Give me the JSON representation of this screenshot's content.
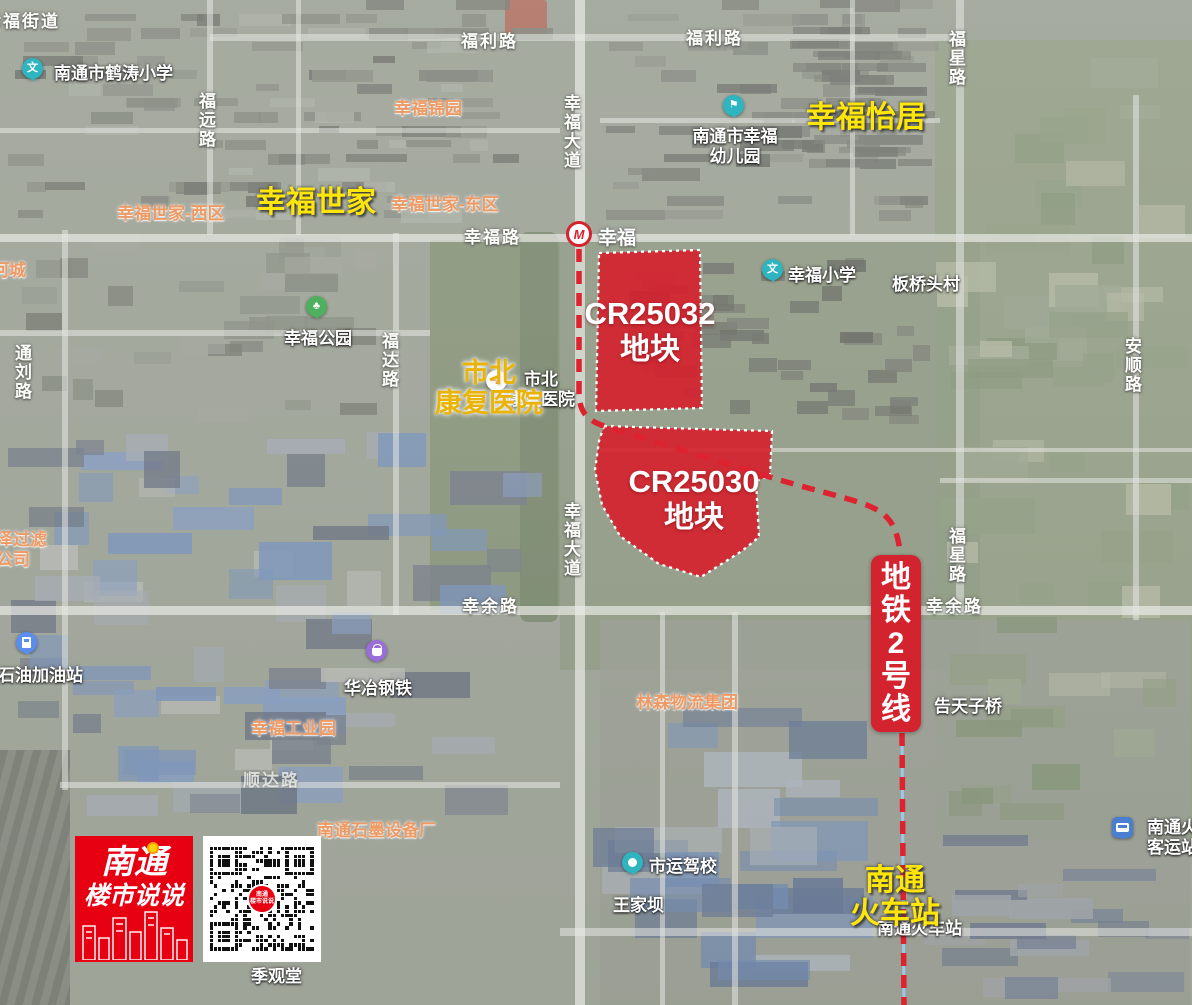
{
  "branding": {
    "logo_line1": "南通",
    "logo_line2": "楼市说说"
  },
  "parcels": [
    {
      "id": "CR25032",
      "label": "地块"
    },
    {
      "id": "CR25030",
      "label": "地块"
    }
  ],
  "metro": {
    "line_label": "地铁2号线",
    "station_name": "幸福"
  },
  "annotations": [
    {
      "name": "annotation-xingfu-shijia",
      "text": "幸福世家",
      "style": "yellow",
      "x": 256,
      "y": 186
    },
    {
      "name": "annotation-xingfu-yiju",
      "text": "幸福怡居",
      "style": "yellow",
      "x": 806,
      "y": 101
    },
    {
      "name": "annotation-shibei-hospital",
      "lines": [
        "市北",
        "康复医院"
      ],
      "style": "gold",
      "cx": 489,
      "y": 358
    },
    {
      "name": "annotation-train-station",
      "lines": [
        "南通",
        "火车站"
      ],
      "style": "yellow",
      "cx": 895,
      "y": 864
    }
  ],
  "map_labels": [
    {
      "name": "street-label-xingfu-jiedao",
      "text": "幸福街道",
      "type": "road",
      "x": -16,
      "y": 12
    },
    {
      "name": "poi-hetao-primary-school",
      "text": "南通市鹤涛小学",
      "type": "poi",
      "x": 54,
      "y": 64,
      "icon": {
        "type": "school",
        "x": 22,
        "y": 58
      }
    },
    {
      "name": "poi-xingfu-jinyuan",
      "text": "幸福锦园",
      "type": "orange",
      "x": 394,
      "y": 99
    },
    {
      "name": "poi-xingfu-shijia-west",
      "text": "幸福世家-西区",
      "type": "orange",
      "x": 117,
      "y": 204
    },
    {
      "name": "poi-xingfu-shijia-east",
      "text": "幸福世家-东区",
      "type": "orange",
      "x": 391,
      "y": 195
    },
    {
      "name": "road-fuli-left",
      "text": "福利路",
      "type": "road",
      "x": 461,
      "y": 32
    },
    {
      "name": "road-fuli-right",
      "text": "福利路",
      "type": "road",
      "x": 686,
      "y": 29
    },
    {
      "name": "road-fuyuan",
      "text": "福远路",
      "type": "road",
      "x": 199,
      "y": 92,
      "vertical": true
    },
    {
      "name": "road-xingfu-avenue-north",
      "text": "幸福大道",
      "type": "road",
      "x": 564,
      "y": 94,
      "vertical": true
    },
    {
      "name": "road-xingfu-avenue-south",
      "text": "幸福大道",
      "type": "road",
      "x": 564,
      "y": 502,
      "vertical": true
    },
    {
      "name": "road-fuxing-north",
      "text": "福星路",
      "type": "road",
      "x": 949,
      "y": 30,
      "vertical": true
    },
    {
      "name": "road-fuxing-south",
      "text": "福星路",
      "type": "road",
      "x": 949,
      "y": 527,
      "vertical": true
    },
    {
      "name": "poi-xingfu-kindergarten",
      "lines": [
        "南通市幸福",
        "幼儿园"
      ],
      "type": "poi",
      "x": 735,
      "y": 127,
      "centered": true,
      "icon": {
        "type": "kindergarten",
        "x": 723,
        "y": 95
      }
    },
    {
      "name": "road-xingfu-road",
      "text": "幸福路",
      "type": "road",
      "x": 464,
      "y": 228
    },
    {
      "name": "poi-hecheng",
      "text": "河城",
      "type": "orange",
      "x": -8,
      "y": 261
    },
    {
      "name": "poi-xingfu-primary-school",
      "text": "幸福小学",
      "type": "poi",
      "x": 788,
      "y": 266,
      "icon": {
        "type": "school",
        "x": 762,
        "y": 259
      }
    },
    {
      "name": "poi-banqiaotou-village",
      "text": "板桥头村",
      "type": "poi",
      "x": 892,
      "y": 275
    },
    {
      "name": "poi-xingfu-park",
      "text": "幸福公园",
      "type": "poi",
      "x": 284,
      "y": 329,
      "icon": {
        "type": "park",
        "x": 306,
        "y": 296
      }
    },
    {
      "name": "road-tongliu",
      "text": "通刘路",
      "type": "road",
      "x": 15,
      "y": 344,
      "vertical": true
    },
    {
      "name": "road-fuda",
      "text": "福达路",
      "type": "road",
      "x": 382,
      "y": 332,
      "vertical": true
    },
    {
      "name": "road-anshun",
      "text": "安顺路",
      "type": "road",
      "x": 1125,
      "y": 337,
      "vertical": true
    },
    {
      "name": "poi-shibei-hospital-map",
      "lines": [
        "市北",
        "康复医院"
      ],
      "type": "poi",
      "x": 541,
      "y": 370,
      "centered": true,
      "icon": {
        "type": "hospital",
        "x": 486,
        "y": 370
      }
    },
    {
      "name": "poi-zeguolv-company",
      "lines": [
        "泽过滤",
        "公司"
      ],
      "type": "orange",
      "x": -4,
      "y": 530
    },
    {
      "name": "road-xingyu-left",
      "text": "幸余路",
      "type": "road",
      "x": 462,
      "y": 597
    },
    {
      "name": "road-xingyu-right",
      "text": "幸余路",
      "type": "road",
      "x": 926,
      "y": 597
    },
    {
      "name": "poi-gas-station",
      "text": "石油加油站",
      "type": "poi",
      "x": -2,
      "y": 666,
      "icon": {
        "type": "gas",
        "x": 16,
        "y": 632
      }
    },
    {
      "name": "poi-huaye-steel",
      "text": "华冶钢铁",
      "type": "poi",
      "x": 344,
      "y": 679,
      "icon": {
        "type": "shop",
        "x": 366,
        "y": 640
      }
    },
    {
      "name": "poi-xingfu-industrial-park",
      "text": "幸福工业园",
      "type": "orange",
      "x": 251,
      "y": 719
    },
    {
      "name": "poi-linsen-logistics",
      "text": "林森物流集团",
      "type": "orange",
      "x": 636,
      "y": 693
    },
    {
      "name": "poi-gaotianzi-bridge",
      "text": "告天子桥",
      "type": "poi",
      "x": 934,
      "y": 697
    },
    {
      "name": "road-shunda",
      "text": "顺达路",
      "type": "road-faint",
      "x": 243,
      "y": 771
    },
    {
      "name": "poi-graphite-factory",
      "text": "南通石墨设备厂",
      "type": "orange",
      "x": 317,
      "y": 821
    },
    {
      "name": "poi-driving-school",
      "text": "市运驾校",
      "type": "poi",
      "x": 649,
      "y": 857,
      "icon": {
        "type": "dot",
        "x": 622,
        "y": 852
      }
    },
    {
      "name": "poi-wangjiaba",
      "text": "王家坝",
      "type": "poi",
      "x": 613,
      "y": 896
    },
    {
      "name": "poi-train-station-map",
      "text": "南通火车站",
      "type": "poi",
      "x": 877,
      "y": 919
    },
    {
      "name": "poi-jiguantang",
      "text": "季观堂",
      "type": "poi",
      "x": 251,
      "y": 967
    },
    {
      "name": "poi-bus-terminal",
      "lines": [
        "南通火车站",
        "客运站"
      ],
      "type": "poi",
      "x": 1147,
      "y": 818,
      "icon": {
        "type": "bus",
        "x": 1112,
        "y": 817
      }
    }
  ]
}
